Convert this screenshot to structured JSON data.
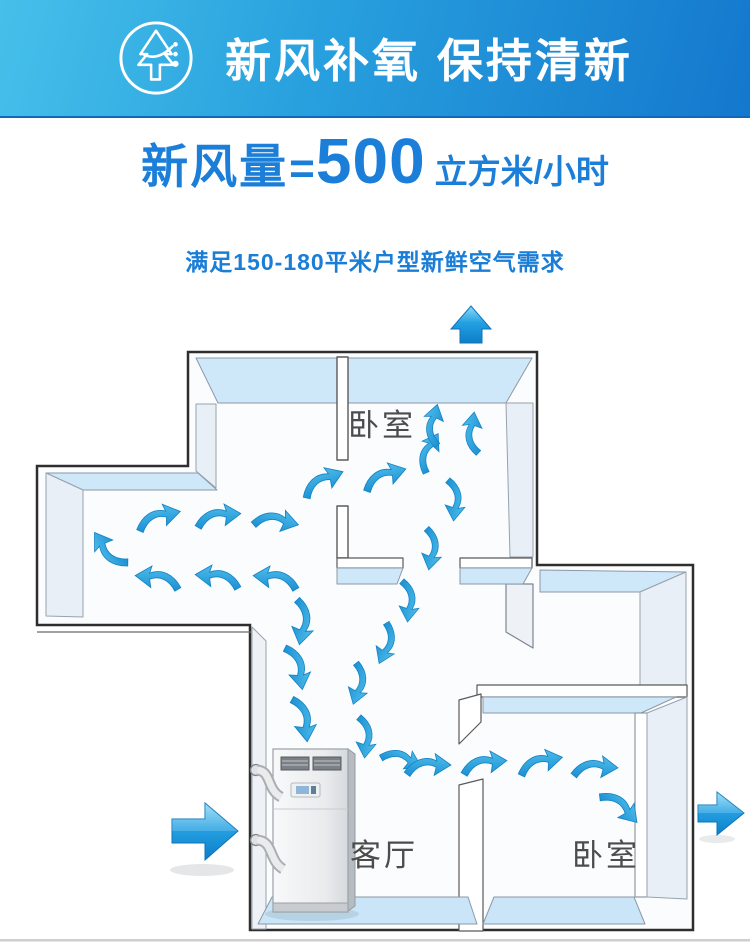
{
  "header": {
    "title": "新风补氧 保持清新",
    "icon": "fresh-air-tree-icon"
  },
  "headline": {
    "prefix": "新风量",
    "equals": "=",
    "value": "500",
    "unit": "立方米/小时"
  },
  "subtitle": "满足150-180平米户型新鲜空气需求",
  "floorplan": {
    "rooms": {
      "top_bedroom": "卧室",
      "living_room": "客厅",
      "right_bedroom": "卧室"
    },
    "device": "fresh-air-ventilation-unit",
    "airflow": {
      "inlet": "left",
      "outlets": [
        "top",
        "right"
      ]
    },
    "colors": {
      "header_gradient_start": "#46c0ea",
      "header_gradient_end": "#1478cd",
      "accent_blue": "#1b7ed8",
      "airflow_arrow": "#2aa3de",
      "wall_top": "#cfe8f9",
      "label_gray": "#4c4c4c"
    }
  }
}
